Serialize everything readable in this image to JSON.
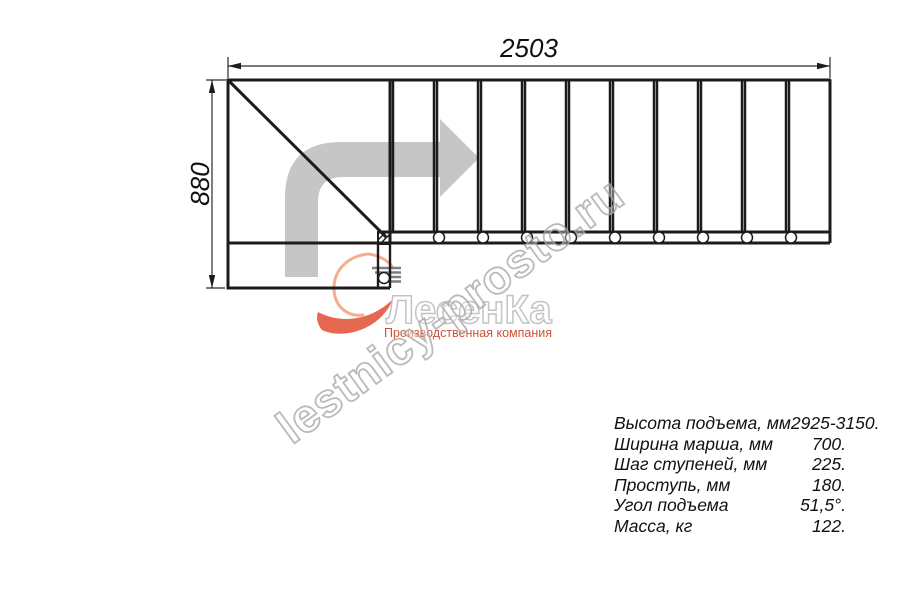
{
  "drawing": {
    "top_dimension_label": "2503",
    "left_dimension_label": "880",
    "tread_count": 10,
    "stringer_circle_count": 9,
    "line_color": "#1c1c1c",
    "arrow_color": "#c6c6c6"
  },
  "watermark": {
    "text": "lestnicy-prosto.ru"
  },
  "logo": {
    "name": "ЛесенКа",
    "tagline": "Производственная компания",
    "flame_light_color": "#f5ad8d",
    "flame_red_color": "#e4583e"
  },
  "specs": {
    "rows": [
      {
        "label": "Высота подъема, мм",
        "value": "2925-3150."
      },
      {
        "label": "Ширина марша, мм",
        "value": "700."
      },
      {
        "label": "Шаг ступеней, мм",
        "value": "225."
      },
      {
        "label": "Проступь, мм",
        "value": "180."
      },
      {
        "label": "Угол подъема",
        "value": "51,5°."
      },
      {
        "label": "Масса, кг",
        "value": "122."
      }
    ]
  }
}
